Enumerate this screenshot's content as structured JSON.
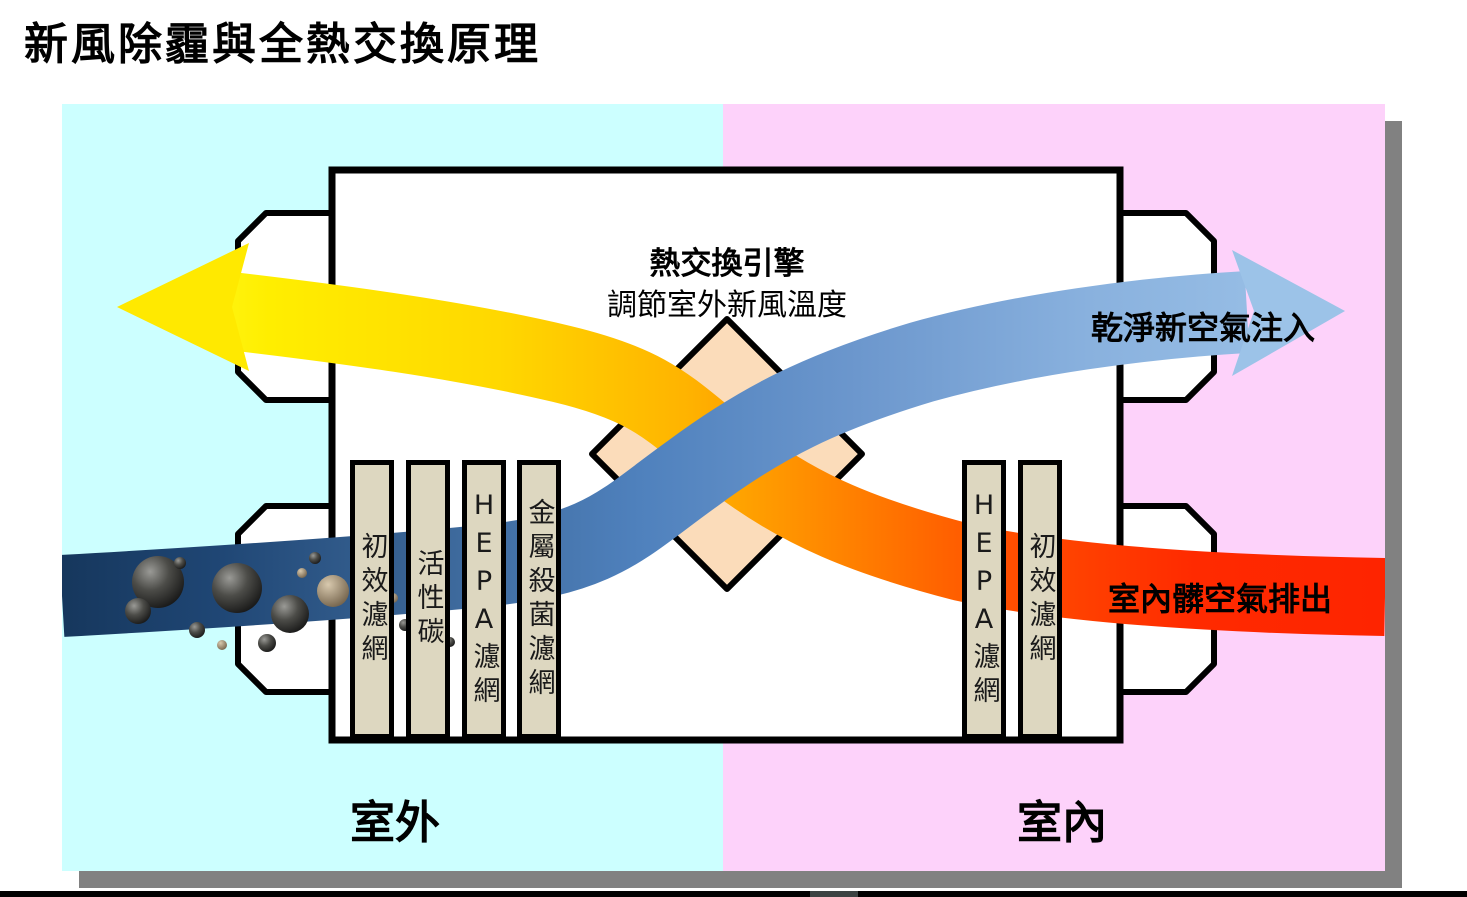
{
  "title": "新風除霾與全熱交換原理",
  "diagram": {
    "zones": {
      "outdoor_label": "室外",
      "indoor_label": "室內"
    },
    "engine": {
      "name": "熱交換引擎",
      "description": "調節室外新風溫度"
    },
    "flows": {
      "clean_air_in": "乾淨新空氣注入",
      "dirty_air_out": "室內髒空氣排出"
    },
    "filters_left": [
      "初效濾網",
      "活性碳",
      "HEPA濾網",
      "金屬殺菌濾網"
    ],
    "filters_right": [
      "HEPA濾網",
      "初效濾網"
    ],
    "colors": {
      "outdoor_bg": "#ccffff",
      "indoor_bg": "#fdd2fa",
      "panel_shadow": "#818181",
      "filter_bar": "#ddd7c0",
      "heat_exchanger_core": "#fbdcba",
      "fresh_air_dark": "#16375d",
      "fresh_air_light": "#9dc3e8",
      "exhaust_yellow": "#ffee00",
      "exhaust_red": "#fe2400"
    }
  }
}
